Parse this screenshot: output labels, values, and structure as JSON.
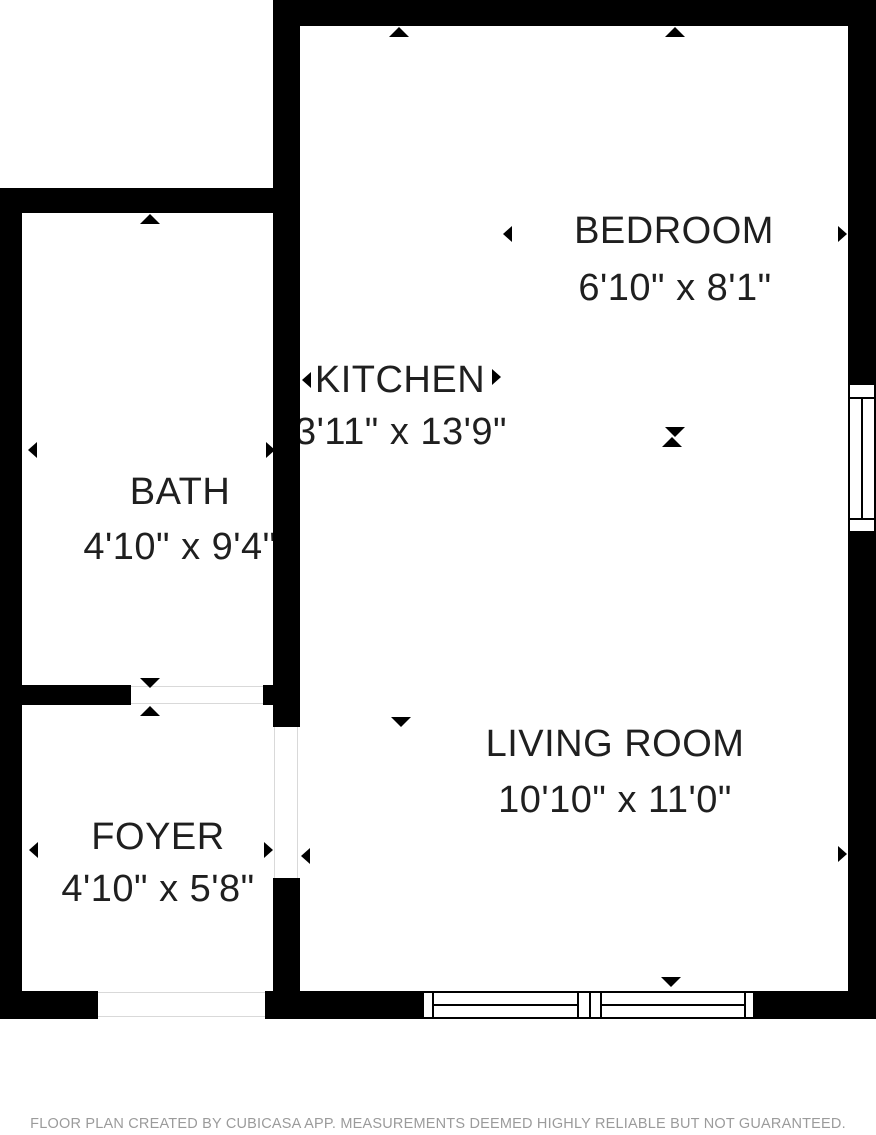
{
  "rooms": {
    "bedroom": {
      "label": "BEDROOM",
      "dimensions": "6'10\" x 8'1\""
    },
    "kitchen": {
      "label": "KITCHEN",
      "dimensions": "3'11\" x 13'9\""
    },
    "bath": {
      "label": "BATH",
      "dimensions": "4'10\" x 9'4\""
    },
    "living_room": {
      "label": "LIVING ROOM",
      "dimensions": "10'10\" x 11'0\""
    },
    "foyer": {
      "label": "FOYER",
      "dimensions": "4'10\" x 5'8\""
    }
  },
  "footer": {
    "text": "FLOOR PLAN CREATED BY CUBICASA APP. MEASUREMENTS DEEMED HIGHLY RELIABLE BUT NOT GUARANTEED."
  },
  "colors": {
    "wall": "#000000",
    "label_text": "#1f1f1f",
    "footer_text": "#9b9b9b",
    "door_line": "#d9d9d9",
    "background": "#ffffff"
  }
}
